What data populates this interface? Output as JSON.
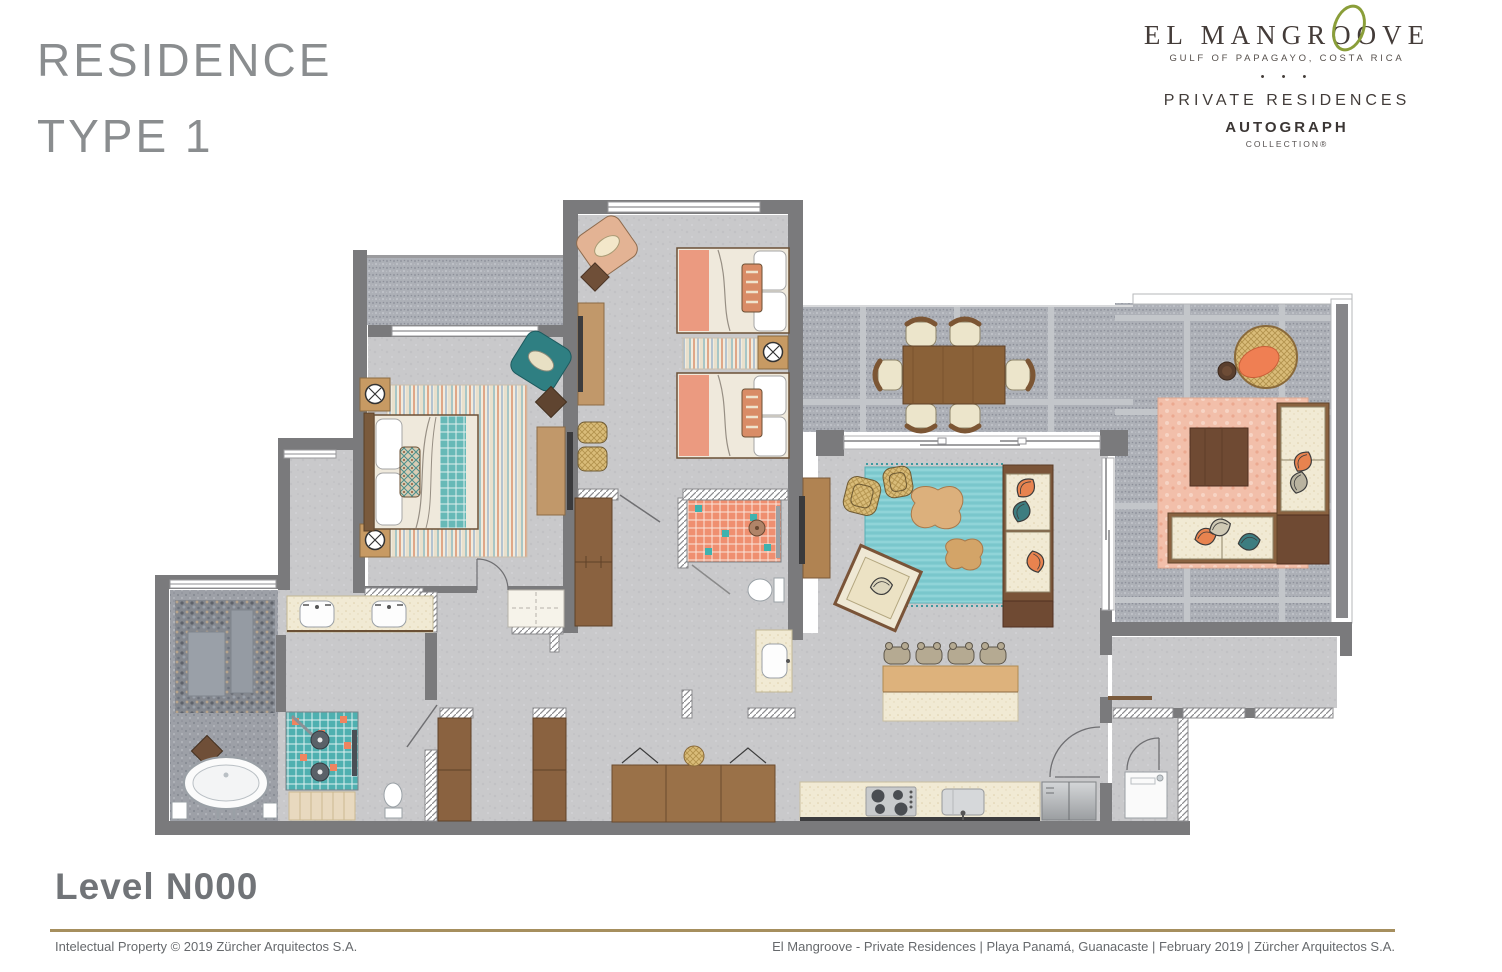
{
  "header": {
    "title_line1": "RESIDENCE",
    "title_line2": "TYPE 1"
  },
  "logo": {
    "brand": "EL MANGROOVE",
    "tagline": "GULF OF PAPAGAYO, COSTA RICA",
    "dots": "• • •",
    "private_residences": "PRIVATE RESIDENCES",
    "autograph": "AUTOGRAPH",
    "collection": "COLLECTION®"
  },
  "plan": {
    "level_label": "Level N000"
  },
  "footer": {
    "left": "Intelectual Property © 2019 Zürcher Arquitectos S.A.",
    "right": "El Mangroove - Private Residences | Playa Panamá, Guanacaste | February 2019 | Zürcher Arquitectos S.A."
  },
  "palette": {
    "wall": "#7a7a7c",
    "interior_floor": "#c9c9cb",
    "terrace_tile": "#adb0b7",
    "pebble_garden": "#84888f",
    "teal_shower_tile": "#4fb0b0",
    "coral_shower_tile": "#ef8f70",
    "teal_rug": "#82ccd1",
    "pink_rug": "#f2bfaa",
    "salmon_bedding": "#eb9a80",
    "cream_upholstery": "#efe8d0",
    "wood_mid": "#a37b4e",
    "wood_dark": "#6f4a33",
    "brand_green": "#8a9e39",
    "brand_dark": "#443c39",
    "gold_rule": "#a68f5e",
    "title_gray": "#8a8d8f"
  }
}
